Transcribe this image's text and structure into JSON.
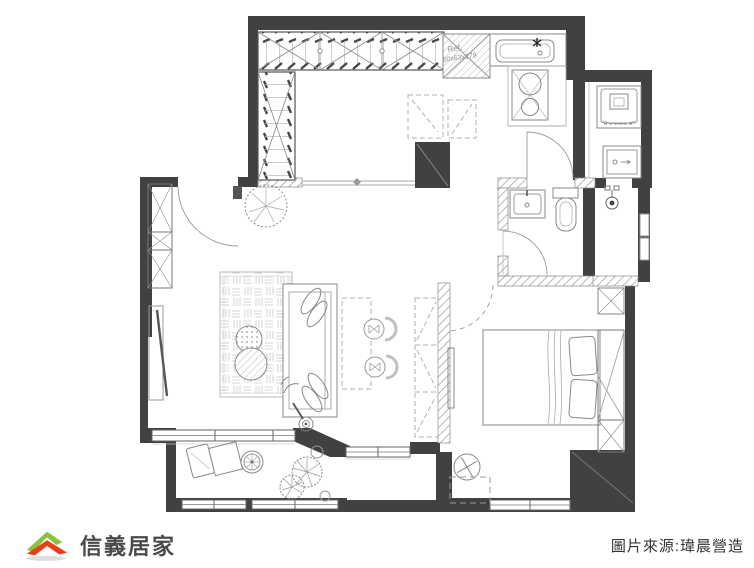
{
  "floor_plan": {
    "title": "apartment-floor-plan",
    "labels": {
      "fridge_line1": "Ref.",
      "fridge_line2": "60x63x178"
    },
    "rooms": [
      "walk-in-closet",
      "kitchen",
      "laundry-room",
      "living-room",
      "dining-area",
      "bathroom",
      "shower-room",
      "bedroom",
      "balcony",
      "entry"
    ],
    "colors": {
      "wall": "#414141",
      "line": "#8a8a8a",
      "line_light": "#bbbbbb",
      "hatch": "#9b9b9b",
      "label_text": "#8f8f8f"
    }
  },
  "footer": {
    "logo_text": "信義居家",
    "logo_green": "#8bc23f",
    "logo_red": "#e8401c",
    "logo_text_color": "#4a4a4a",
    "source_text": "圖片來源:瑋晨營造",
    "source_text_color": "#333333"
  }
}
